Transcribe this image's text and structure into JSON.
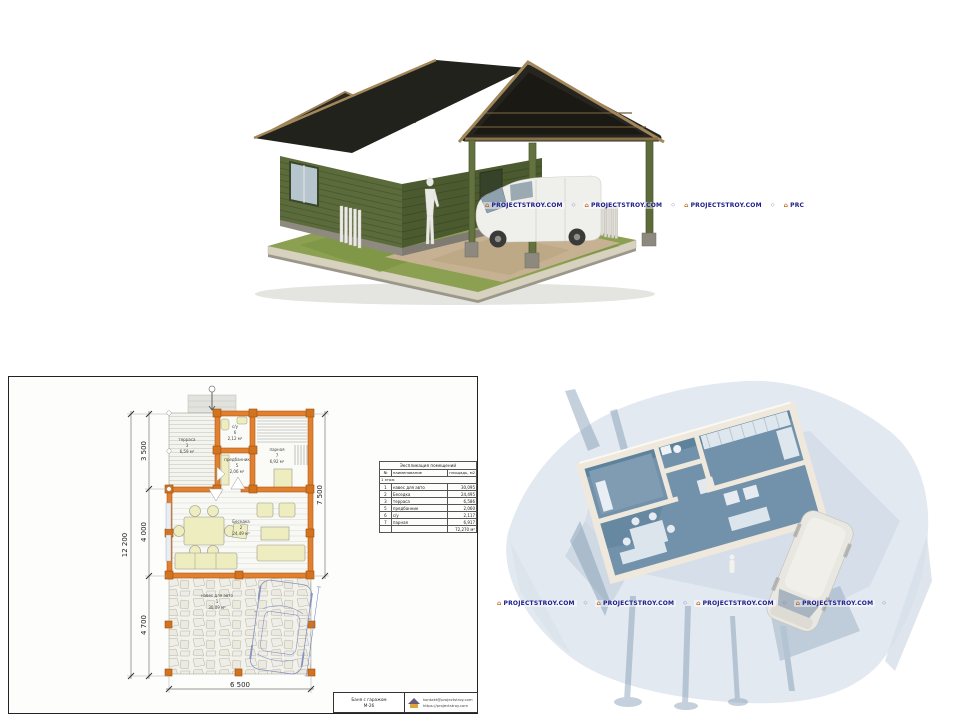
{
  "watermarks": {
    "brand": "PROJECTSTROY.COM",
    "brand_clipped": "PRC",
    "icon_glyph": "⌂",
    "separator_glyph": "◇",
    "text_color": "#1c1c8a"
  },
  "floor_plan": {
    "dimensions": {
      "overall_height": "12 200",
      "segment_top": "3 500",
      "segment_middle": "4 000",
      "segment_bottom": "4 700",
      "right_height": "7 500",
      "bottom_width": "6 500"
    },
    "rooms": {
      "terrace": {
        "name": "терраса",
        "number": "3",
        "area": "6,59 м²"
      },
      "wc": {
        "name": "с/у",
        "number": "6",
        "area": "2,12 м²"
      },
      "dressing": {
        "name": "предбанник",
        "number": "5",
        "area": "2,06 м²"
      },
      "steam": {
        "name": "парная",
        "number": "7",
        "area": "6,92 м²"
      },
      "gazebo": {
        "name": "Беседка",
        "number": "2",
        "area": "24,49 м²"
      },
      "carport": {
        "name": "навес для авто",
        "number": "1",
        "area": "30,09 м²"
      }
    },
    "explication": {
      "title": "Экспликация помещений",
      "col_num": "№",
      "col_name": "наименование",
      "col_area": "площадь, м2",
      "section": "1 этаж",
      "rows": [
        {
          "num": "1",
          "name": "навес для авто",
          "area": "30,095"
        },
        {
          "num": "2",
          "name": "Беседка",
          "area": "24,495"
        },
        {
          "num": "3",
          "name": "терраса",
          "area": "6,586"
        },
        {
          "num": "5",
          "name": "предбанник",
          "area": "2,060"
        },
        {
          "num": "6",
          "name": "с/у",
          "area": "2,117"
        },
        {
          "num": "7",
          "name": "парная",
          "area": "6,917"
        }
      ],
      "total": "72,270 м²"
    },
    "title_block": {
      "project_name": "Баня с гаражом",
      "project_code": "М-26",
      "email": "kontakt@projectstroy.com",
      "website": "https://projectstroy.com"
    }
  }
}
